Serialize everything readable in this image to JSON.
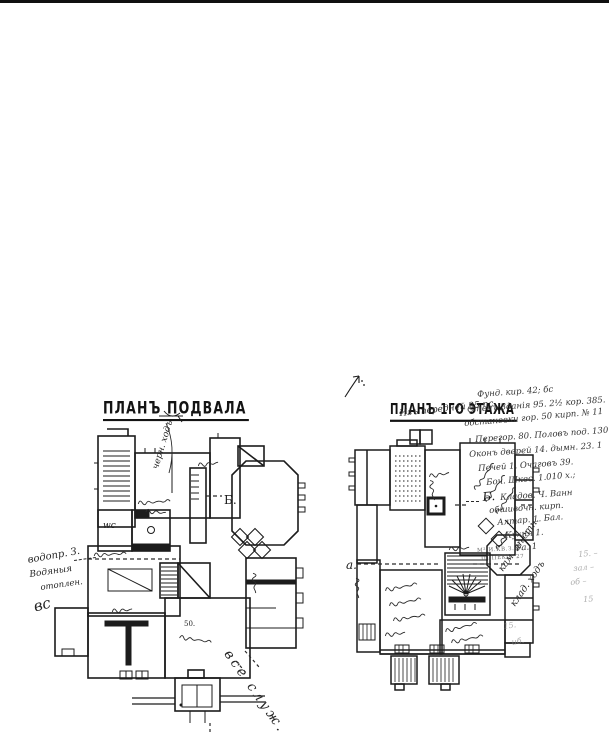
{
  "page": {
    "paper": "#ffffff",
    "ink": "#1c1c1c"
  },
  "basement": {
    "title": "ПЛАНЪ ПОДВАЛА",
    "labels": {
      "section_b": "Б.",
      "wc": "wc",
      "room_number": "50."
    },
    "annotations": {
      "top_diagonal": "черн. ходъ",
      "left_1": "водопр. З.",
      "left_2": "Водяныя",
      "left_3": "отоплен.",
      "left_4": "вс",
      "bottom_diagonal": "все служ. м."
    }
  },
  "first_floor": {
    "title": "ПЛАНЪ 1ГО ЭТАЖА",
    "subtitle": "Изъ передней 25 пс.",
    "labels": {
      "section_a": "а.",
      "section_b": "Б."
    },
    "notes": [
      "Фунд. кир. 42; бс",
      "Стенъ Зданія 95. 2½ кор. 385.",
      "обстановки гор. 50 кирп. № 11",
      "Перегор. 80. Половъ под. 130. 1",
      "Оконъ дверей 14. дымн. 23. 1",
      "Печей 1. Очаговъ 39.",
      "Боч. Шкес. 1.010 х.;",
      "Кладов. Ч. Ванн",
      "обшивочн. кирп.",
      "Алтар. 1. Бал.",
      "Кухня 1.",
      "Фа. 1"
    ],
    "micro_notes": [
      "М² И.КВ.З. 1.",
      "ІІІ ПЕКС. 27"
    ],
    "margin_notes": [
      "15. –",
      "зал –",
      "об –",
      "15",
      "15.",
      "иб."
    ],
    "side_notes": [
      "кам. лѣстн.",
      "клад. ходъ"
    ]
  },
  "icons": {
    "corner_mark": "arrow-doodle",
    "stove": "thick-square-with-dot",
    "stairs": "hatched-run",
    "floor_pattern": "diamond-checker"
  }
}
